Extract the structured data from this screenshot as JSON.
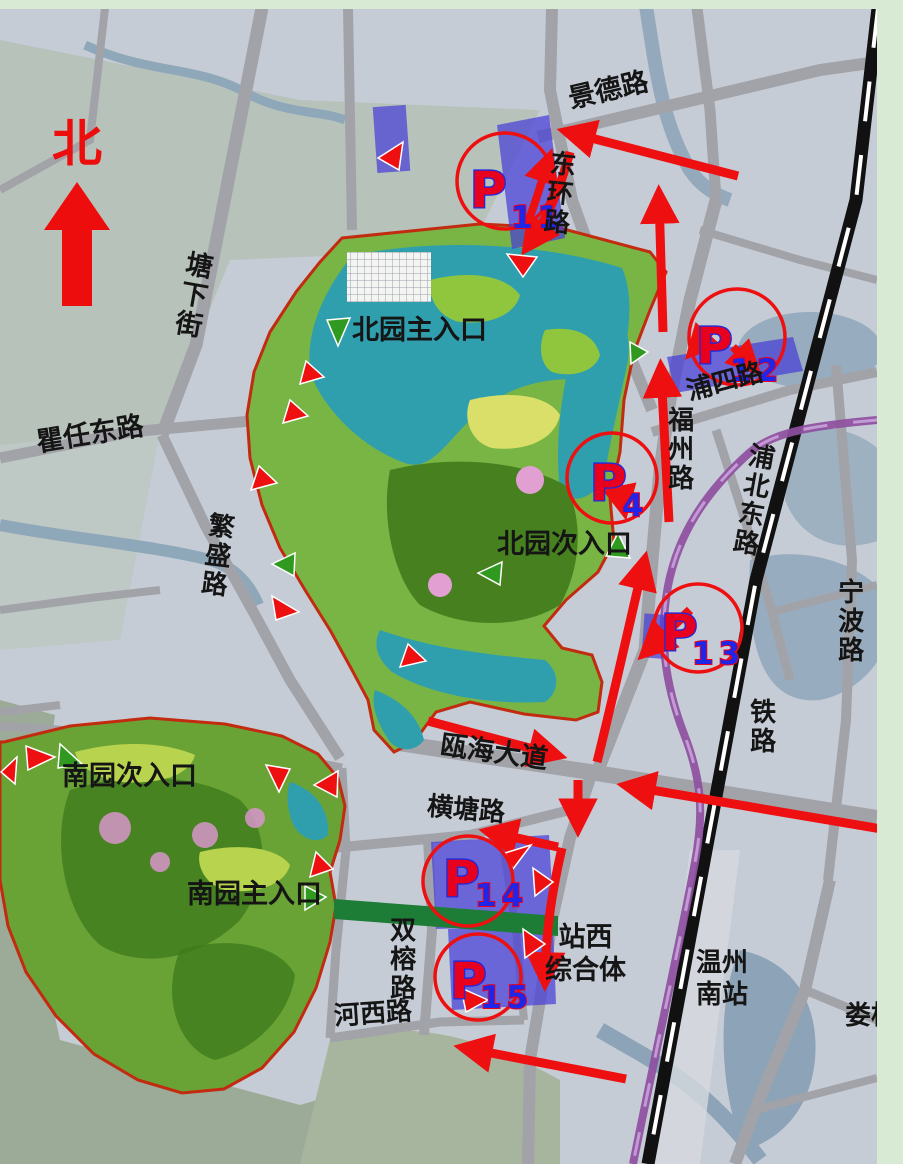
{
  "compass": {
    "north_label": "北"
  },
  "roads": {
    "tangxiajie": "塘下街",
    "jingde": "景德路",
    "donghuan": "东环路",
    "quren": "瞿任东路",
    "fansheng": "繁盛路",
    "fuzhou": "福州路",
    "pusi": "浦四路",
    "pubei": "浦北东路",
    "ningbo": "宁波路",
    "tielu": "铁路",
    "ouhai": "瓯海大道",
    "hengtang": "横塘路",
    "shuangrong": "双榕路",
    "hexi": "河西路",
    "louqiao": "娄桥"
  },
  "entrances": {
    "north_main": "北园主入口",
    "north_secondary": "北园次入口",
    "south_secondary": "南园次入口",
    "south_main": "南园主入口"
  },
  "places": {
    "station_west_line1": "站西",
    "station_west_line2": "综合体",
    "wenzhou_south_line1": "温州",
    "wenzhou_south_line2": "南站"
  },
  "parking": {
    "p11": {
      "letter": "P",
      "num": "11"
    },
    "p12": {
      "letter": "P",
      "num": "12"
    },
    "p4": {
      "letter": "P",
      "num": "4"
    },
    "p13": {
      "letter": "P",
      "num": "13"
    },
    "p14": {
      "letter": "P",
      "num": "14"
    },
    "p15": {
      "letter": "P",
      "num": "15"
    }
  },
  "colors": {
    "flow_red": "#ee1010",
    "parking_blue": "rgba(72,62,215,0.72)",
    "marker_letter_red": "#e8001f",
    "marker_num_blue": "#2026e8",
    "entrance_green": "#2f9a1f",
    "metro_purple": "#8e4fa0",
    "greenway_green": "#1d7c35",
    "frame_green": "#d8e9d4",
    "boundary_red": "#c22b10"
  }
}
